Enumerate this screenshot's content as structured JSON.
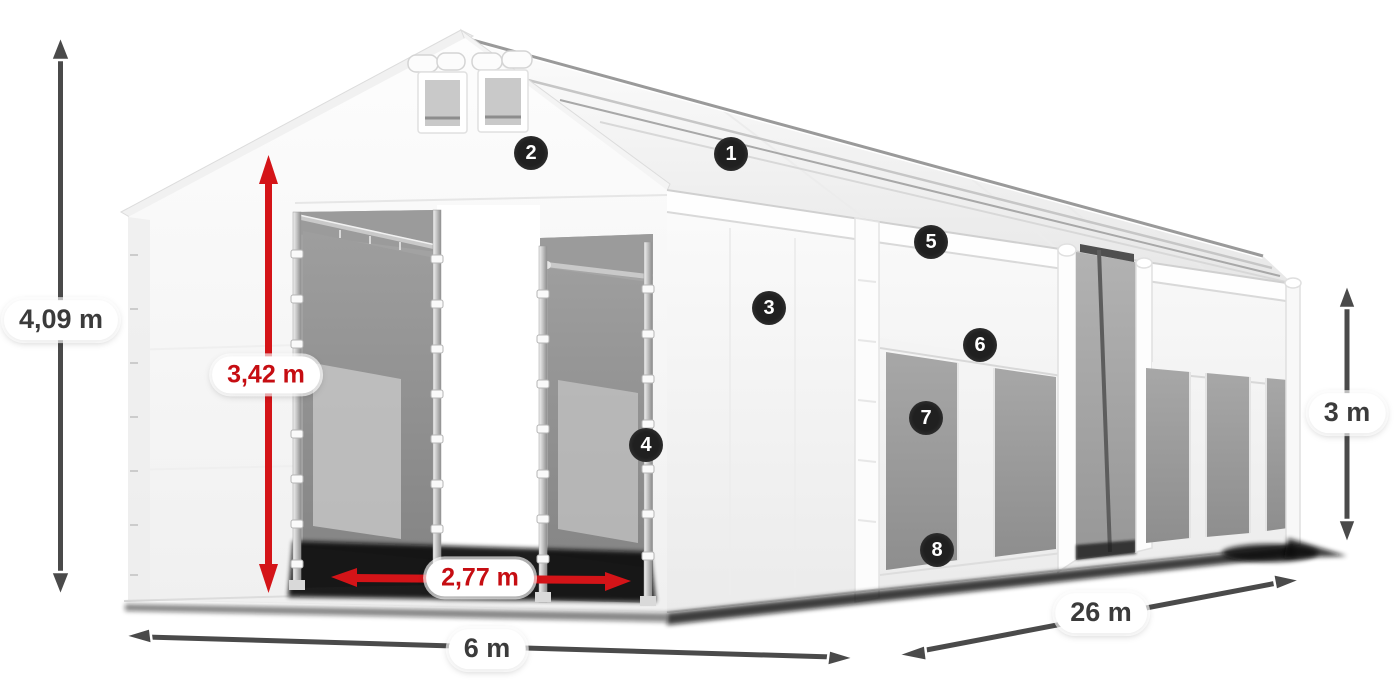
{
  "diagram": {
    "title": "tent-dimensions-diagram",
    "background": "#ffffff",
    "colors": {
      "dimension_dark": "#4a4a4a",
      "dimension_red": "#d41418",
      "label_text_dark": "#3b3b3b",
      "label_text_red": "#c60d12",
      "callout_bg": "#202020",
      "callout_text": "#ffffff"
    },
    "dimensions": {
      "total_height": "4,09 m",
      "entrance_height": "3,42 m",
      "entrance_width": "2,77 m",
      "front_width": "6 m",
      "side_length": "26 m",
      "side_wall_height": "3 m"
    },
    "callouts": [
      {
        "number": "1"
      },
      {
        "number": "2"
      },
      {
        "number": "3"
      },
      {
        "number": "4"
      },
      {
        "number": "5"
      },
      {
        "number": "6"
      },
      {
        "number": "7"
      },
      {
        "number": "8"
      }
    ]
  }
}
